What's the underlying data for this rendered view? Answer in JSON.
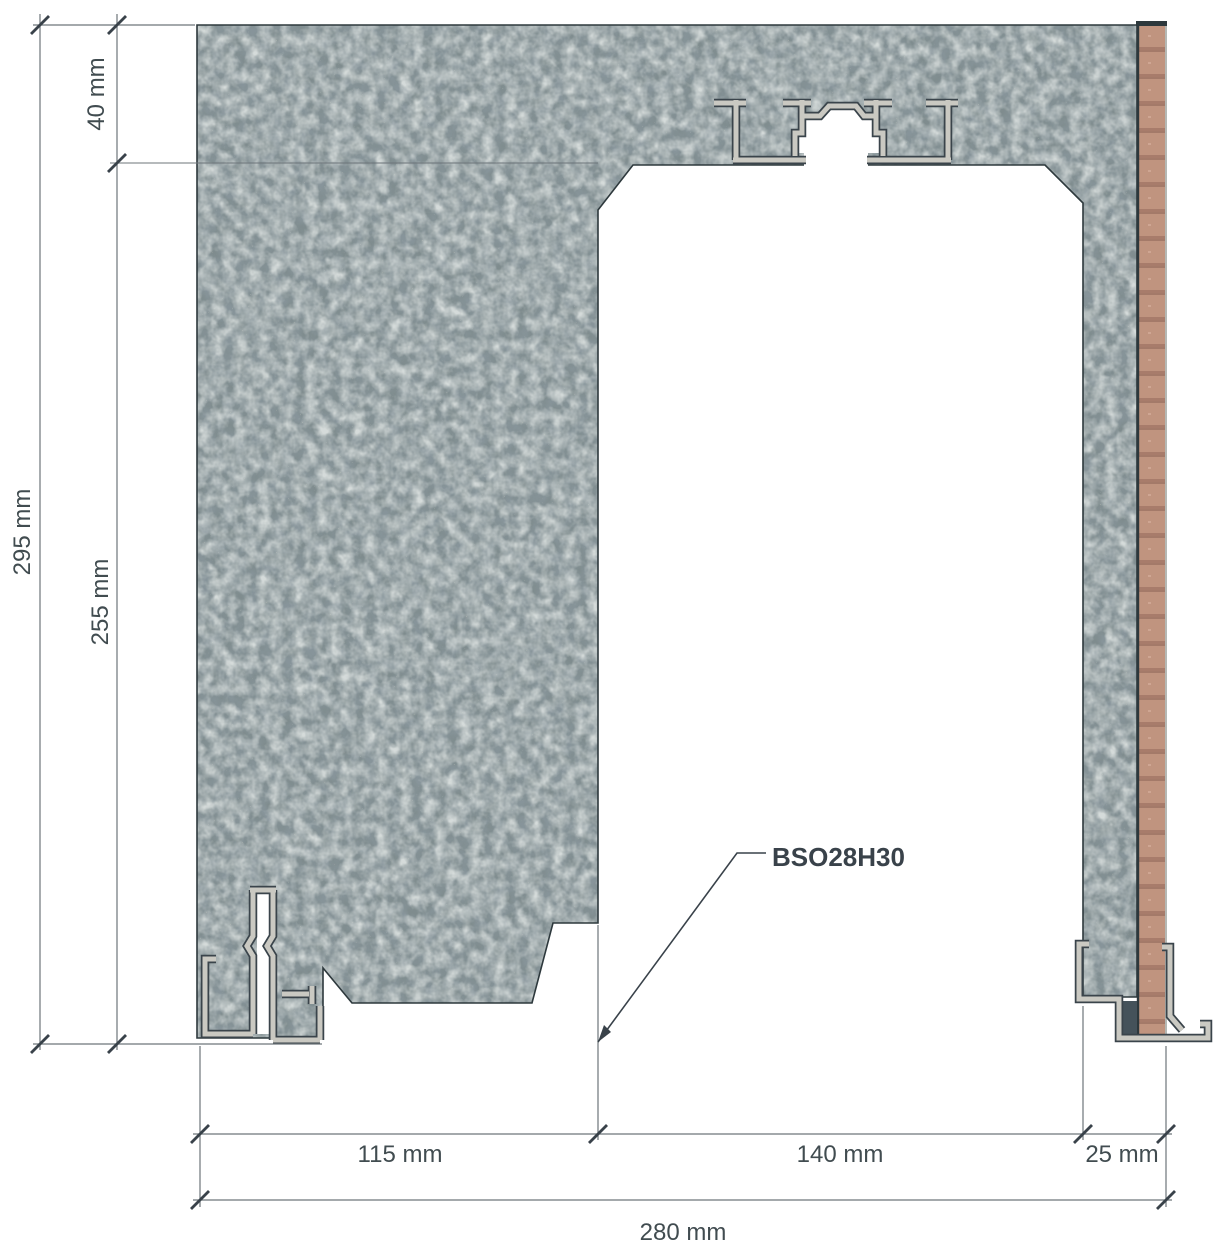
{
  "drawing": {
    "label": "BSO28H30",
    "dimensions": {
      "top_offset": "40 mm",
      "overall_height": "295 mm",
      "inner_height": "255 mm",
      "left_wall_width": "115 mm",
      "opening_width": "140 mm",
      "panel_width": "25 mm",
      "overall_width": "280 mm"
    },
    "materials": {
      "wall": "concrete",
      "panel": "wood",
      "profiles": "aluminum"
    },
    "colors": {
      "background": "#ffffff",
      "dim_line": "#6d767a",
      "tick": "#39424a",
      "dim_text": "#414c50",
      "label_text": "#39424a",
      "concrete_base": "#7f8c8e",
      "concrete_dark": "#3e4c52",
      "concrete_light": "#a9b4b2",
      "outline": "#2d383c",
      "aluminum_fill": "#cac9c2",
      "aluminum_outline": "#3a444b",
      "wood_base": "#c0947f",
      "wood_band": "#a87c6b",
      "seal": "#45525a"
    }
  }
}
